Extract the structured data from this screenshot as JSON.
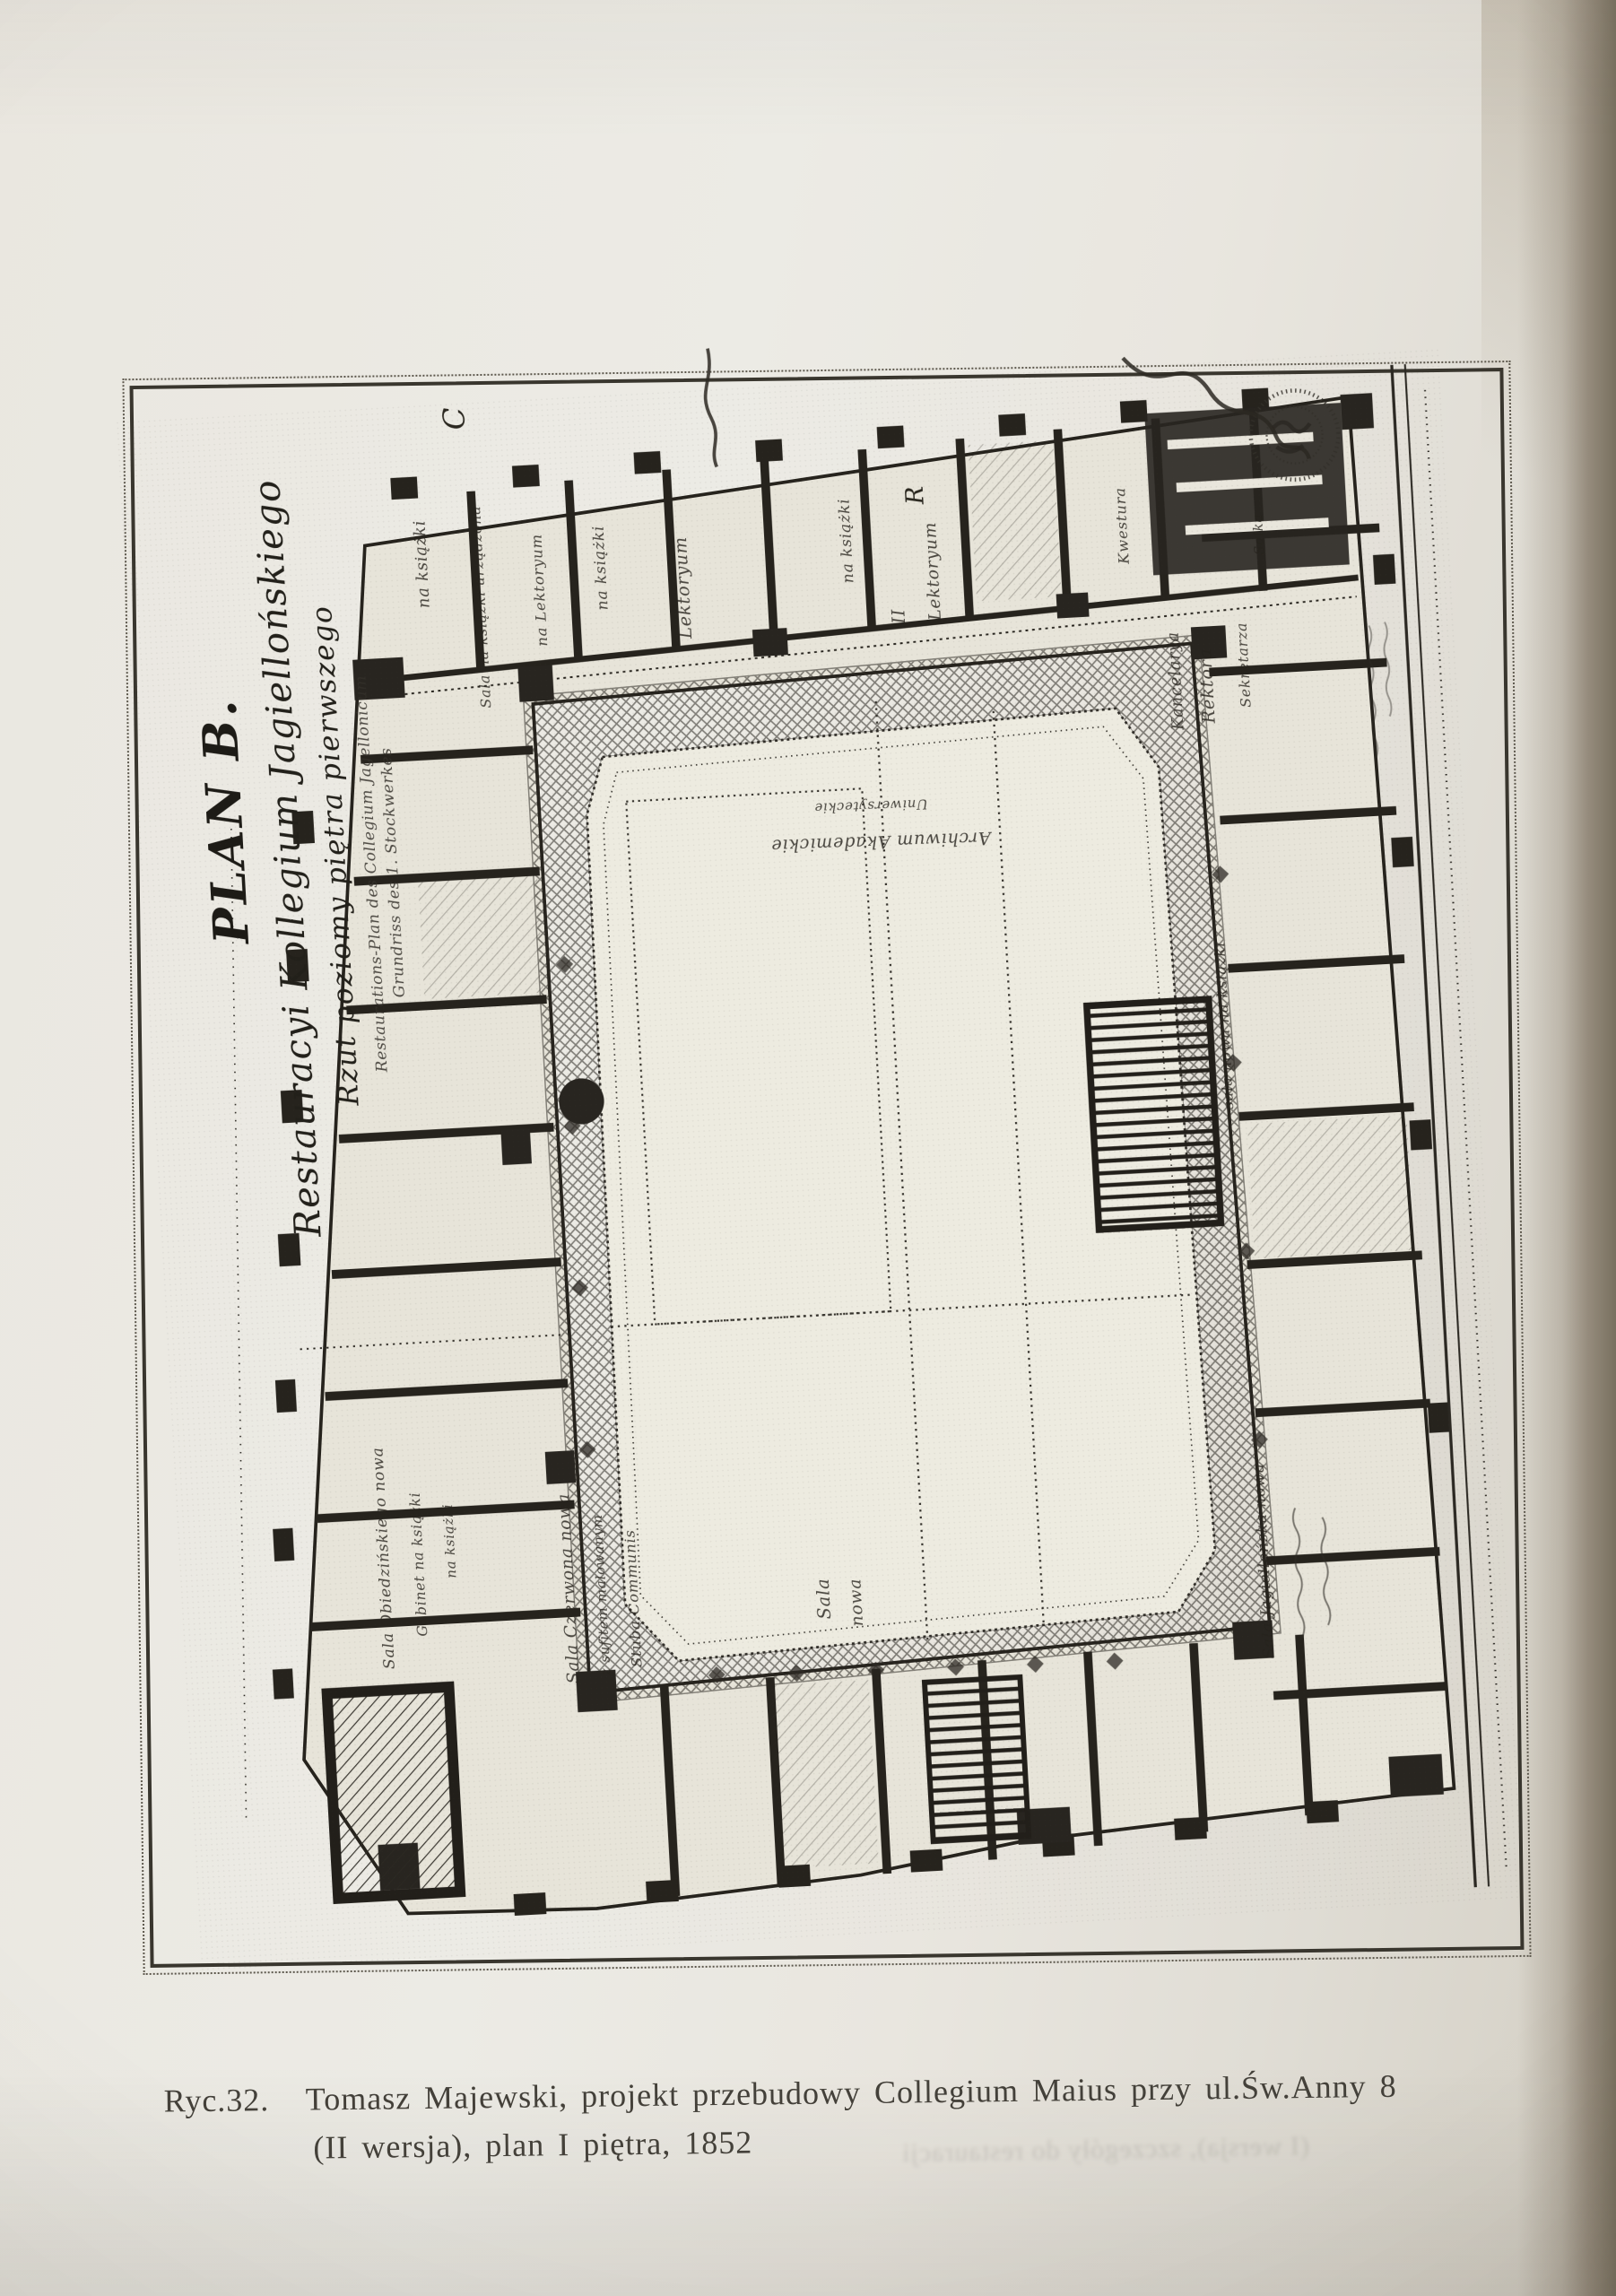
{
  "figure": {
    "caption": {
      "label": "Ryc.32.",
      "line1": "Tomasz Majewski, projekt przebudowy Collegium Maius przy ul.Św.Anny 8",
      "line2": "(II wersja), plan I piętra, 1852"
    },
    "show_through": "(I wersja), szczegóły do restauracji"
  },
  "plan": {
    "title": {
      "line1": "PLAN B.",
      "line2": "Restauracyi Kollegium Jagiellońskiego",
      "line3": "Rzut poziomy piętra pierwszego",
      "line4": "Restaurations-Plan des Collegium Jagellonicum",
      "line5": "Grundriss des 1. Stockwerkes"
    },
    "corner_letters": {
      "c": "C",
      "r": "R"
    },
    "labels": {
      "na_ksiazki_1": "na książki",
      "sala_na_ksiazki": "Sala na książki urządzona",
      "na_lektoryum": "na Lektoryum",
      "na_ksiazki_2": "na książki",
      "lektoryum_1": "Lektoryum",
      "na_ksiazki_3": "na książki",
      "lektoryum_2": "Lektoryum",
      "numeral_2": "II",
      "archiwum_1": "Archiwum Akademickie",
      "archiwum_2": "Uniwersyteckie",
      "kwestura": "Kwestura",
      "kancelarya": "Kancelarya",
      "rektora": "Rektora",
      "salka": "Salka",
      "sekretarza": "Sekretarza",
      "sala_nowa_na_ksiazki": "sala nowa na książki",
      "sala_obiedzinskiego": "Sala Obiedzińskiego nowa",
      "gabinet": "Gabinet na książki",
      "na_ksiazki_4": "na książki",
      "sala_czerwona": "Sala Czerwona nowa",
      "sufitem": "z sufitem malowanym",
      "stuba": "Stuba Communis",
      "sala": "Sala",
      "nowa": "nowa",
      "sala_jagiellonska": "Sala Jagiellońska nowa"
    }
  },
  "colors": {
    "paper": "#e9e6de",
    "plan_band": "#e7e4d9",
    "ink": "#26231d",
    "caption_ink": "#44413a",
    "photo_edge": "#78705f"
  }
}
